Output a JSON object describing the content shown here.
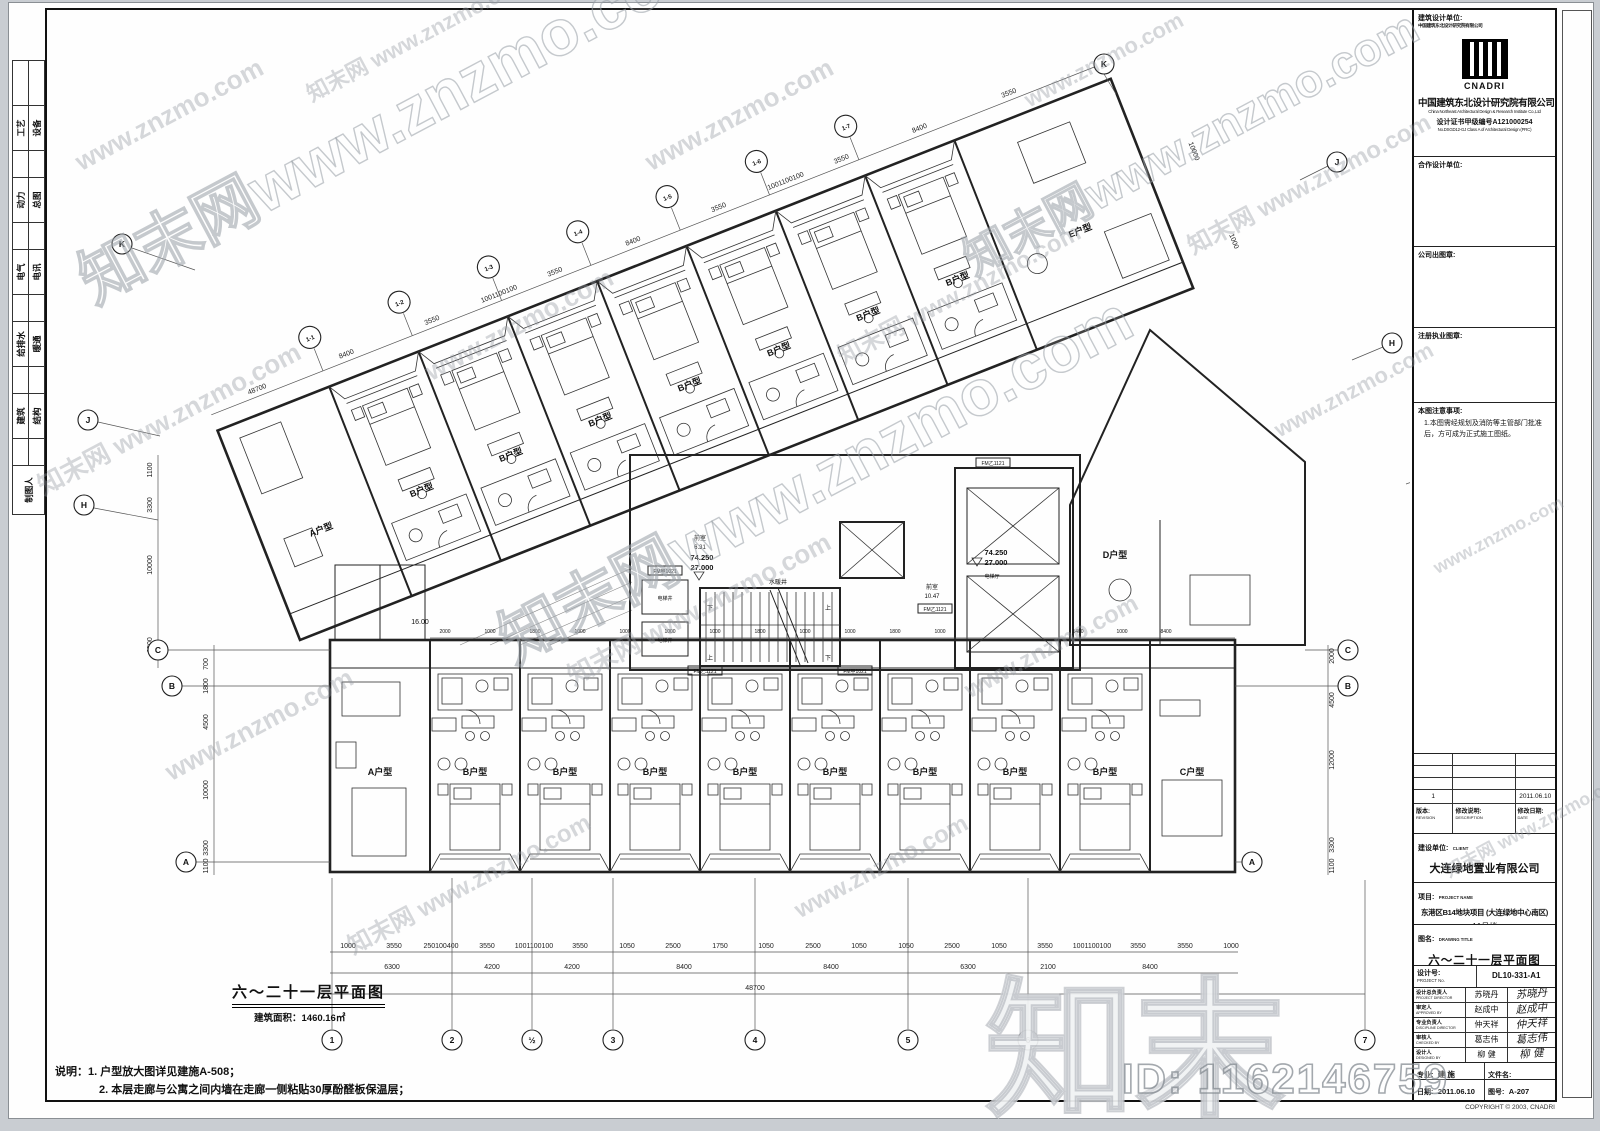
{
  "watermark": {
    "site_tile": "知末网 www.znzmo.com",
    "url_tile": "www.znzmo.com",
    "big_text": "知末网www.znzmo.com",
    "big_logo": "知末",
    "id_text": "ID: 1162146759"
  },
  "left_tabs": {
    "pairs": [
      [
        "工艺",
        "设备"
      ],
      [
        "动力",
        "总图"
      ],
      [
        "电气",
        "电讯"
      ],
      [
        "给排水",
        "暖通"
      ],
      [
        "建筑",
        "结构"
      ]
    ],
    "drafter": "制图人"
  },
  "title_block": {
    "design_unit_label": "建筑设计单位:",
    "design_unit_sub": "中国建筑东北设计研究院有限公司",
    "logo_name": "CNADRI",
    "company_cn": "中国建筑东北设计研究院有限公司",
    "company_en": "China Northeast Architectural Design & Research Institute Co.,Ltd",
    "cert_cn": "设计证书甲级编号A121000254",
    "cert_en": "No.DSGD12-GJ Class A of Architectural Design (PRC)",
    "coop_label": "合作设计单位:",
    "company_seal_label": "公司出图章:",
    "registry_seal_label": "注册执业图章:",
    "notice_label": "本图注意事项:",
    "notice_text": "1.本图需经规划及消防等主管部门批准后，方可成为正式施工图纸。",
    "revision": {
      "row_no": "1",
      "row_desc": "",
      "row_date": "2011.06.10",
      "h_no_cn": "版本:",
      "h_no_en": "REVISION",
      "h_desc_cn": "修改说明:",
      "h_desc_en": "DESCRIPTION",
      "h_date_cn": "修改日期:",
      "h_date_en": "DATE"
    },
    "client_label_cn": "建设单位:",
    "client_label_en": "CLIENT",
    "client": "大连绿地置业有限公司",
    "project_label_cn": "项目:",
    "project_label_en": "PROJECT NAME",
    "project": "东港区B14地块项目 (大连绿地中心南区)",
    "building": "A1号楼",
    "title_label_cn": "图名:",
    "title_label_en": "DRAWING TITLE",
    "drawing_title": "六～二十一层平面图",
    "projno_label_cn": "设计号:",
    "projno_label_en": "PROJECT No.",
    "project_no": "DL10-331-A1",
    "signers": [
      {
        "role": "设计总负责人",
        "en": "PROJECT DIRECTOR",
        "name": "苏晓丹"
      },
      {
        "role": "审定人",
        "en": "APPROVED BY",
        "name": "赵成中"
      },
      {
        "role": "专业负责人",
        "en": "DISCIPLINE DIRECTOR",
        "name": "仲天祥"
      },
      {
        "role": "审核人",
        "en": "CHECKED BY",
        "name": "葛志伟"
      },
      {
        "role": "设计人",
        "en": "DESIGNED BY",
        "name": "柳 健"
      }
    ],
    "discipline_label_cn": "专业:",
    "discipline_label_en": "DWG.",
    "discipline": "建 施",
    "file_label_cn": "文件名:",
    "file_label_en": "FILE NAME",
    "file_name": "Plan.DWG",
    "date_label_cn": "日期:",
    "date_label_en": "DATE",
    "date": "2011.06.10",
    "dwgno_label_cn": "图号:",
    "dwgno_label_en": "DRAWING No.",
    "dwg_no": "A-207",
    "copyright": "COPYRIGHT © 2003, CNADRI"
  },
  "plan": {
    "title": "六～二十一层平面图",
    "area": "建筑面积：1460.16㎡",
    "note1": "说明：1. 户型放大图详见建施A-508；",
    "note2": "2. 本层走廊与公寓之间内墙在走廊一侧粘贴30厚酚醛板保温层；",
    "units": {
      "a": "A户型",
      "b": "B户型",
      "c": "C户型",
      "d": "D户型",
      "e": "E户型"
    },
    "core": {
      "vestibule": "前室",
      "area1": "6.31",
      "area2": "10.47",
      "lvl_hi": "74.250",
      "lvl_lo": "27.000",
      "corr": "16.00",
      "up": "上",
      "dn": "下",
      "shaft_mech": "水暖井",
      "shaft_lift": "电梯井",
      "lift_lobby": "电梯厅",
      "tag1": "FM乙1121",
      "tag2": "FM甲1021"
    },
    "grid": {
      "b1": "1",
      "b2": "2",
      "b2a": "½",
      "b3": "3",
      "b4": "4",
      "b5": "5",
      "b6": "6",
      "b7": "7",
      "a1": "1-1",
      "a2": "1-2",
      "a3": "1-3",
      "a4": "1-4",
      "a5": "1-5",
      "a6": "1-6",
      "a7": "1-7",
      "lK": "K",
      "lJ": "J",
      "lH": "H",
      "rK": "K",
      "rJ": "J",
      "rH": "H",
      "rH2": "H",
      "lC": "C",
      "lB": "B",
      "lA": "A",
      "rC": "C",
      "rB": "B",
      "rA": "A"
    },
    "dims": {
      "row1": [
        "1000",
        "3550",
        "250100400",
        "3550",
        "1001100100",
        "3550",
        "1050",
        "2500",
        "1750",
        "1050",
        "2500",
        "1050",
        "1050",
        "2500",
        "1050",
        "3550",
        "1001100100",
        "3550",
        "3550",
        "1000"
      ],
      "row2": [
        "6300",
        "4200",
        "4200",
        "8400",
        "8400",
        "6300",
        "2100",
        "8400"
      ],
      "total": "48700",
      "ang": [
        "48700",
        "8400",
        "3550",
        "1001100100",
        "3550",
        "8400",
        "3550",
        "1001100100",
        "3550",
        "8400",
        "3550"
      ],
      "top": [
        "2000",
        "1000",
        "1800",
        "1000",
        "1000",
        "1000",
        "1000",
        "1800",
        "1000",
        "1000",
        "1800",
        "1000",
        "1400",
        "1000",
        "8400"
      ],
      "lv": [
        "1100",
        "3300",
        "10000",
        "6500"
      ],
      "lv2": [
        "700",
        "1800",
        "4500",
        "10000",
        "3300",
        "1100"
      ],
      "rv": [
        "2000",
        "4500",
        "12000",
        "3300",
        "1100"
      ],
      "ae": [
        "1000",
        "10000"
      ]
    }
  }
}
